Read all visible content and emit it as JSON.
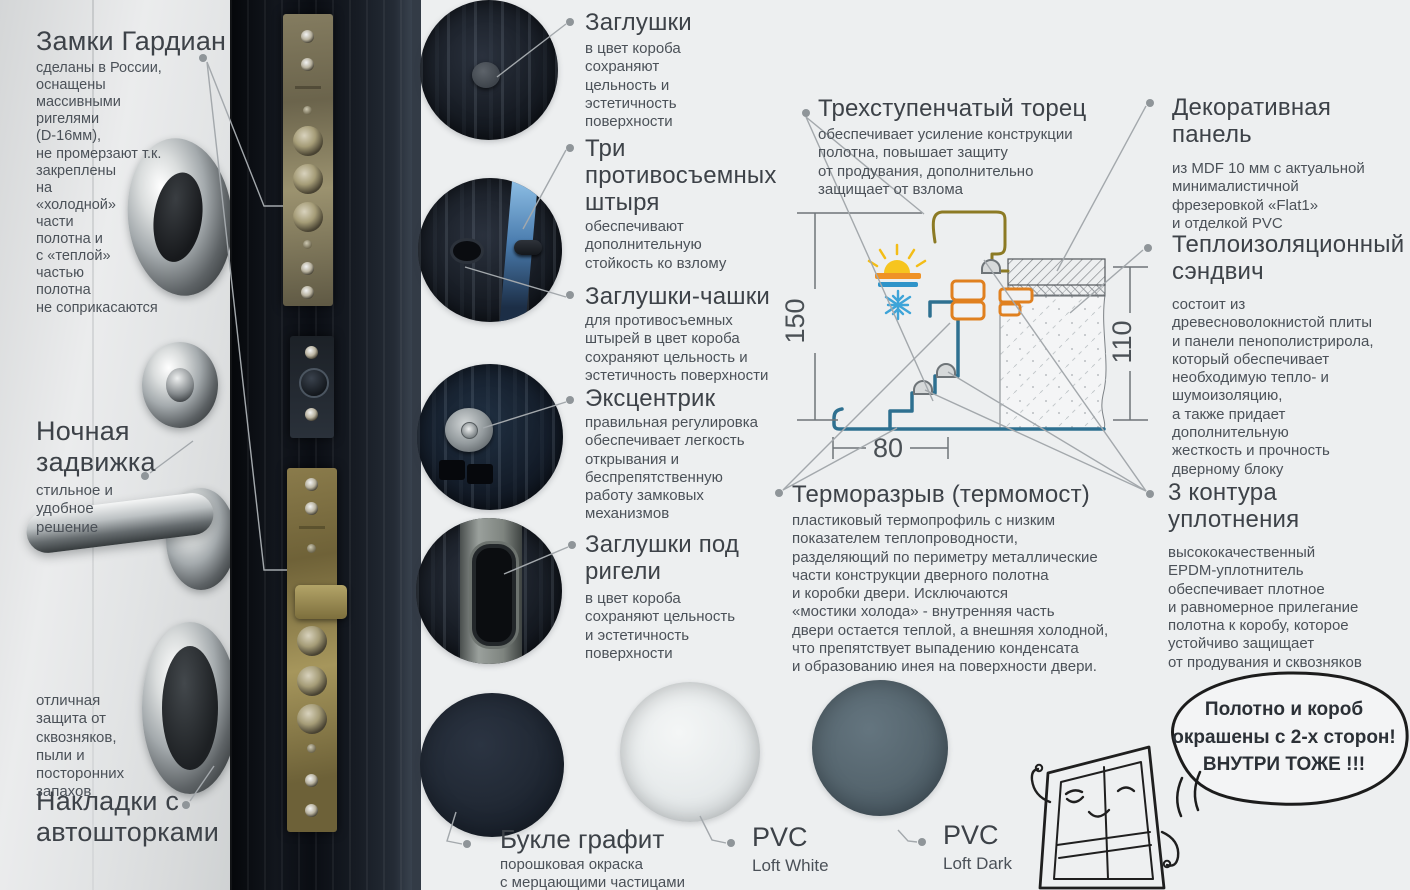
{
  "colors": {
    "background": "#edeff0",
    "heading_text": "#3d4248",
    "body_text": "#4b5158",
    "leader_line": "#a3a8ac",
    "frame_profile_blue": "#2e7090",
    "thermal_break_orange": "#e0801f",
    "leaf_profile_olive": "#8c7a24",
    "sun_yellow": "#f6c51f",
    "warm_bar_orange": "#ef9226",
    "cold_blue": "#3ea4d8",
    "graphite_swatch": "#1e2731",
    "loft_white_swatch": "#e3e7e8",
    "loft_dark_swatch": "#56666f"
  },
  "left": {
    "locks": {
      "title": "Замки Гардиан",
      "body": "сделаны в России,\nоснащены\nмассивными\nригелями\n(D-16мм),\nне промерзают т.к.\nзакреплены\nна\n«холодной»\nчасти\nполотна и\nс «теплой»\nчастью\nполотна\nне соприкасаются"
    },
    "night_latch": {
      "title": "Ночная\nзадвижка",
      "body": "стильное и\nудобное\nрешение"
    },
    "covers_note": "отличная\nзащита от\nсквозняков,\nпыли и\nпосторонних\nзапахов",
    "covers_title": "Накладки с\nавтошторками"
  },
  "callouts": [
    {
      "title": "Заглушки",
      "body": "в цвет короба\nсохраняют\nцельность и\nэстетичность\nповерхности"
    },
    {
      "title": "Три\nпротивосъемных\nштыря",
      "body": "обеспечивают\nдополнительную\nстойкость ко взлому"
    },
    {
      "title": "Заглушки-чашки",
      "body": "для противосъемных\nштырей в цвет короба\nсохраняют цельность и\nэстетичность поверхности"
    },
    {
      "title": "Эксцентрик",
      "body": "правильная регулировка\nобеспечивает легкость\nоткрывания и\nбеспрепятственную\nработу замковых\nмеханизмов"
    },
    {
      "title": "Заглушки под\nригели",
      "body": "в цвет короба\nсохраняют цельность\nи эстетичность\nповерхности"
    }
  ],
  "diagram": {
    "edge": {
      "title": "Трехступенчатый торец",
      "body": "обеспечивает усиление конструкции\nполотна, повышает защиту\nот продувания, дополнительно\nзащищает от взлома"
    },
    "panel": {
      "title": "Декоративная\nпанель",
      "body": "из MDF 10 мм с актуальной\nминималистичной\nфрезеровкой «Flat1»\nи отделкой PVC"
    },
    "sandwich": {
      "title": "Теплоизоляционный\nсэндвич",
      "body": "состоит из\nдревесноволокнистой плиты\nи панели пенополистрирола,\nкоторый обеспечивает\nнеобходимую тепло- и\nшумоизоляцию,\nа также придает\nдополнительную\nжесткость и прочность\nдверному блоку"
    },
    "thermal": {
      "title": "Терморазрыв (термомост)",
      "body": "пластиковый термопрофиль с низким\nпоказателем теплопроводности,\nразделяющий по периметру металлические\nчасти конструкции дверного полотна\nи коробки двери. Исключаются\n«мостики холода» - внутренняя часть\nдвери остается теплой, а внешняя холодной,\nчто препятствует выпадению конденсата\nи образованию инея на поверхности двери."
    },
    "seals": {
      "title": "3 контура\nуплотнения",
      "body": "высококачественный\nEPDM-уплотнитель\nобеспечивает плотное\nи равномерное прилегание\nполотна к коробу, которое\nустойчиво защищает\nот продувания и сквозняков"
    },
    "dims": {
      "height": "150",
      "depth": "110",
      "width": "80"
    }
  },
  "finishes": [
    {
      "title": "Букле графит",
      "body": "порошковая окраска\nс мерцающими частицами",
      "color": "#1e2731"
    },
    {
      "title": "PVC",
      "body": "Loft White",
      "color": "#e3e7e8"
    },
    {
      "title": "PVC",
      "body": "Loft Dark",
      "color": "#56666f"
    }
  ],
  "bubble": {
    "line1": "Полотно и короб",
    "line2": "окрашены с 2-х сторон!",
    "line3": "ВНУТРИ ТОЖЕ !!!"
  }
}
